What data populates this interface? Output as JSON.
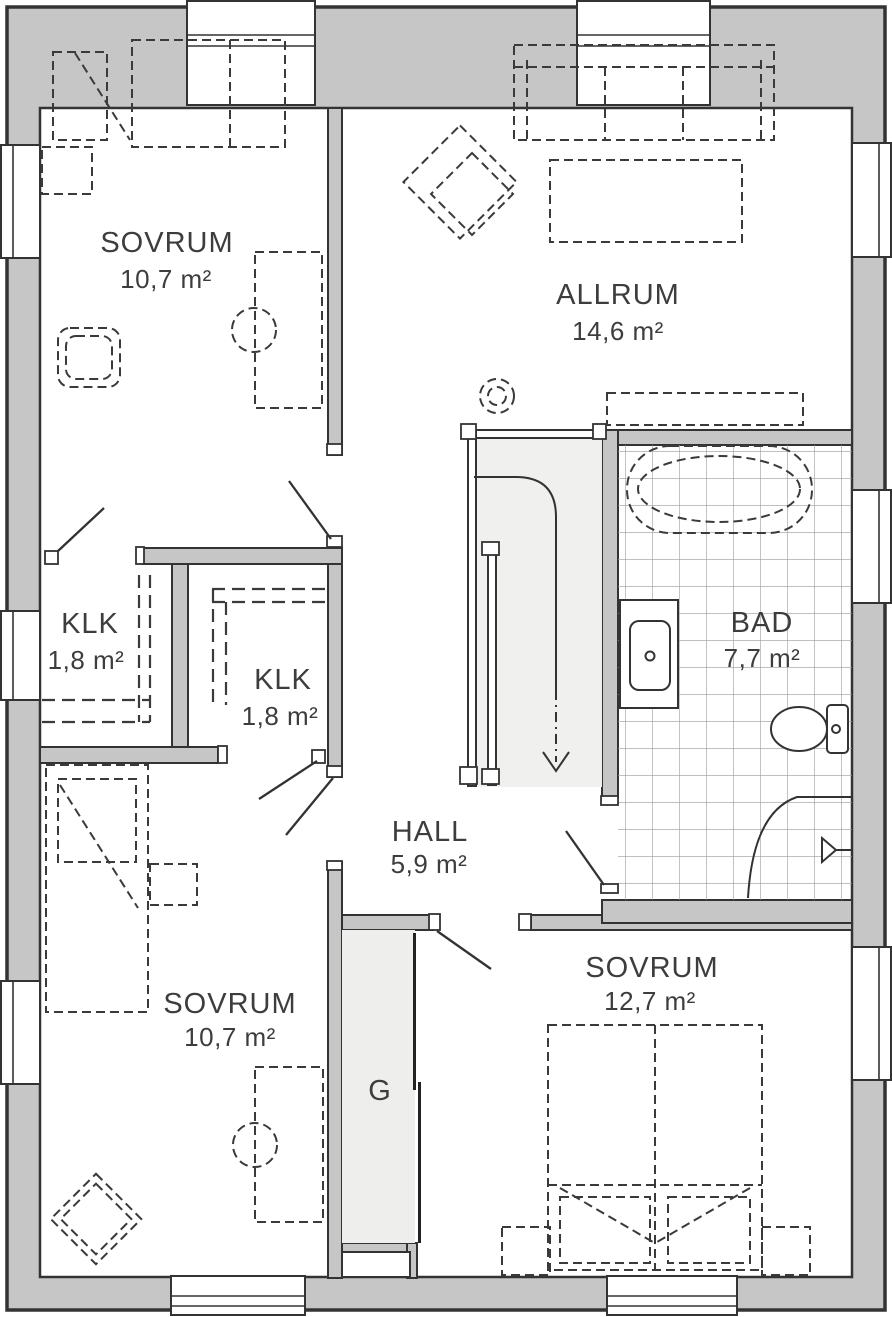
{
  "plan": {
    "type": "floor-plan",
    "rooms": [
      {
        "id": "sovrum-1",
        "name": "SOVRUM",
        "area": "10,7 m²"
      },
      {
        "id": "allrum",
        "name": "ALLRUM",
        "area": "14,6 m²"
      },
      {
        "id": "klk-1",
        "name": "KLK",
        "area": "1,8 m²"
      },
      {
        "id": "klk-2",
        "name": "KLK",
        "area": "1,8 m²"
      },
      {
        "id": "bad",
        "name": "BAD",
        "area": "7,7 m²"
      },
      {
        "id": "hall",
        "name": "HALL",
        "area": "5,9 m²"
      },
      {
        "id": "sovrum-2",
        "name": "SOVRUM",
        "area": "10,7 m²"
      },
      {
        "id": "sovrum-3",
        "name": "SOVRUM",
        "area": "12,7 m²"
      },
      {
        "id": "garderob",
        "name": "G",
        "area": ""
      }
    ],
    "colors": {
      "wall_fill": "#c6c6c6",
      "wall_line": "#333333",
      "floor": "#ffffff",
      "stair_fill": "#f0f0ee",
      "closet_fill": "#eeeeec",
      "tile_line": "#9b9b9b",
      "text": "#3d3d3d"
    }
  }
}
